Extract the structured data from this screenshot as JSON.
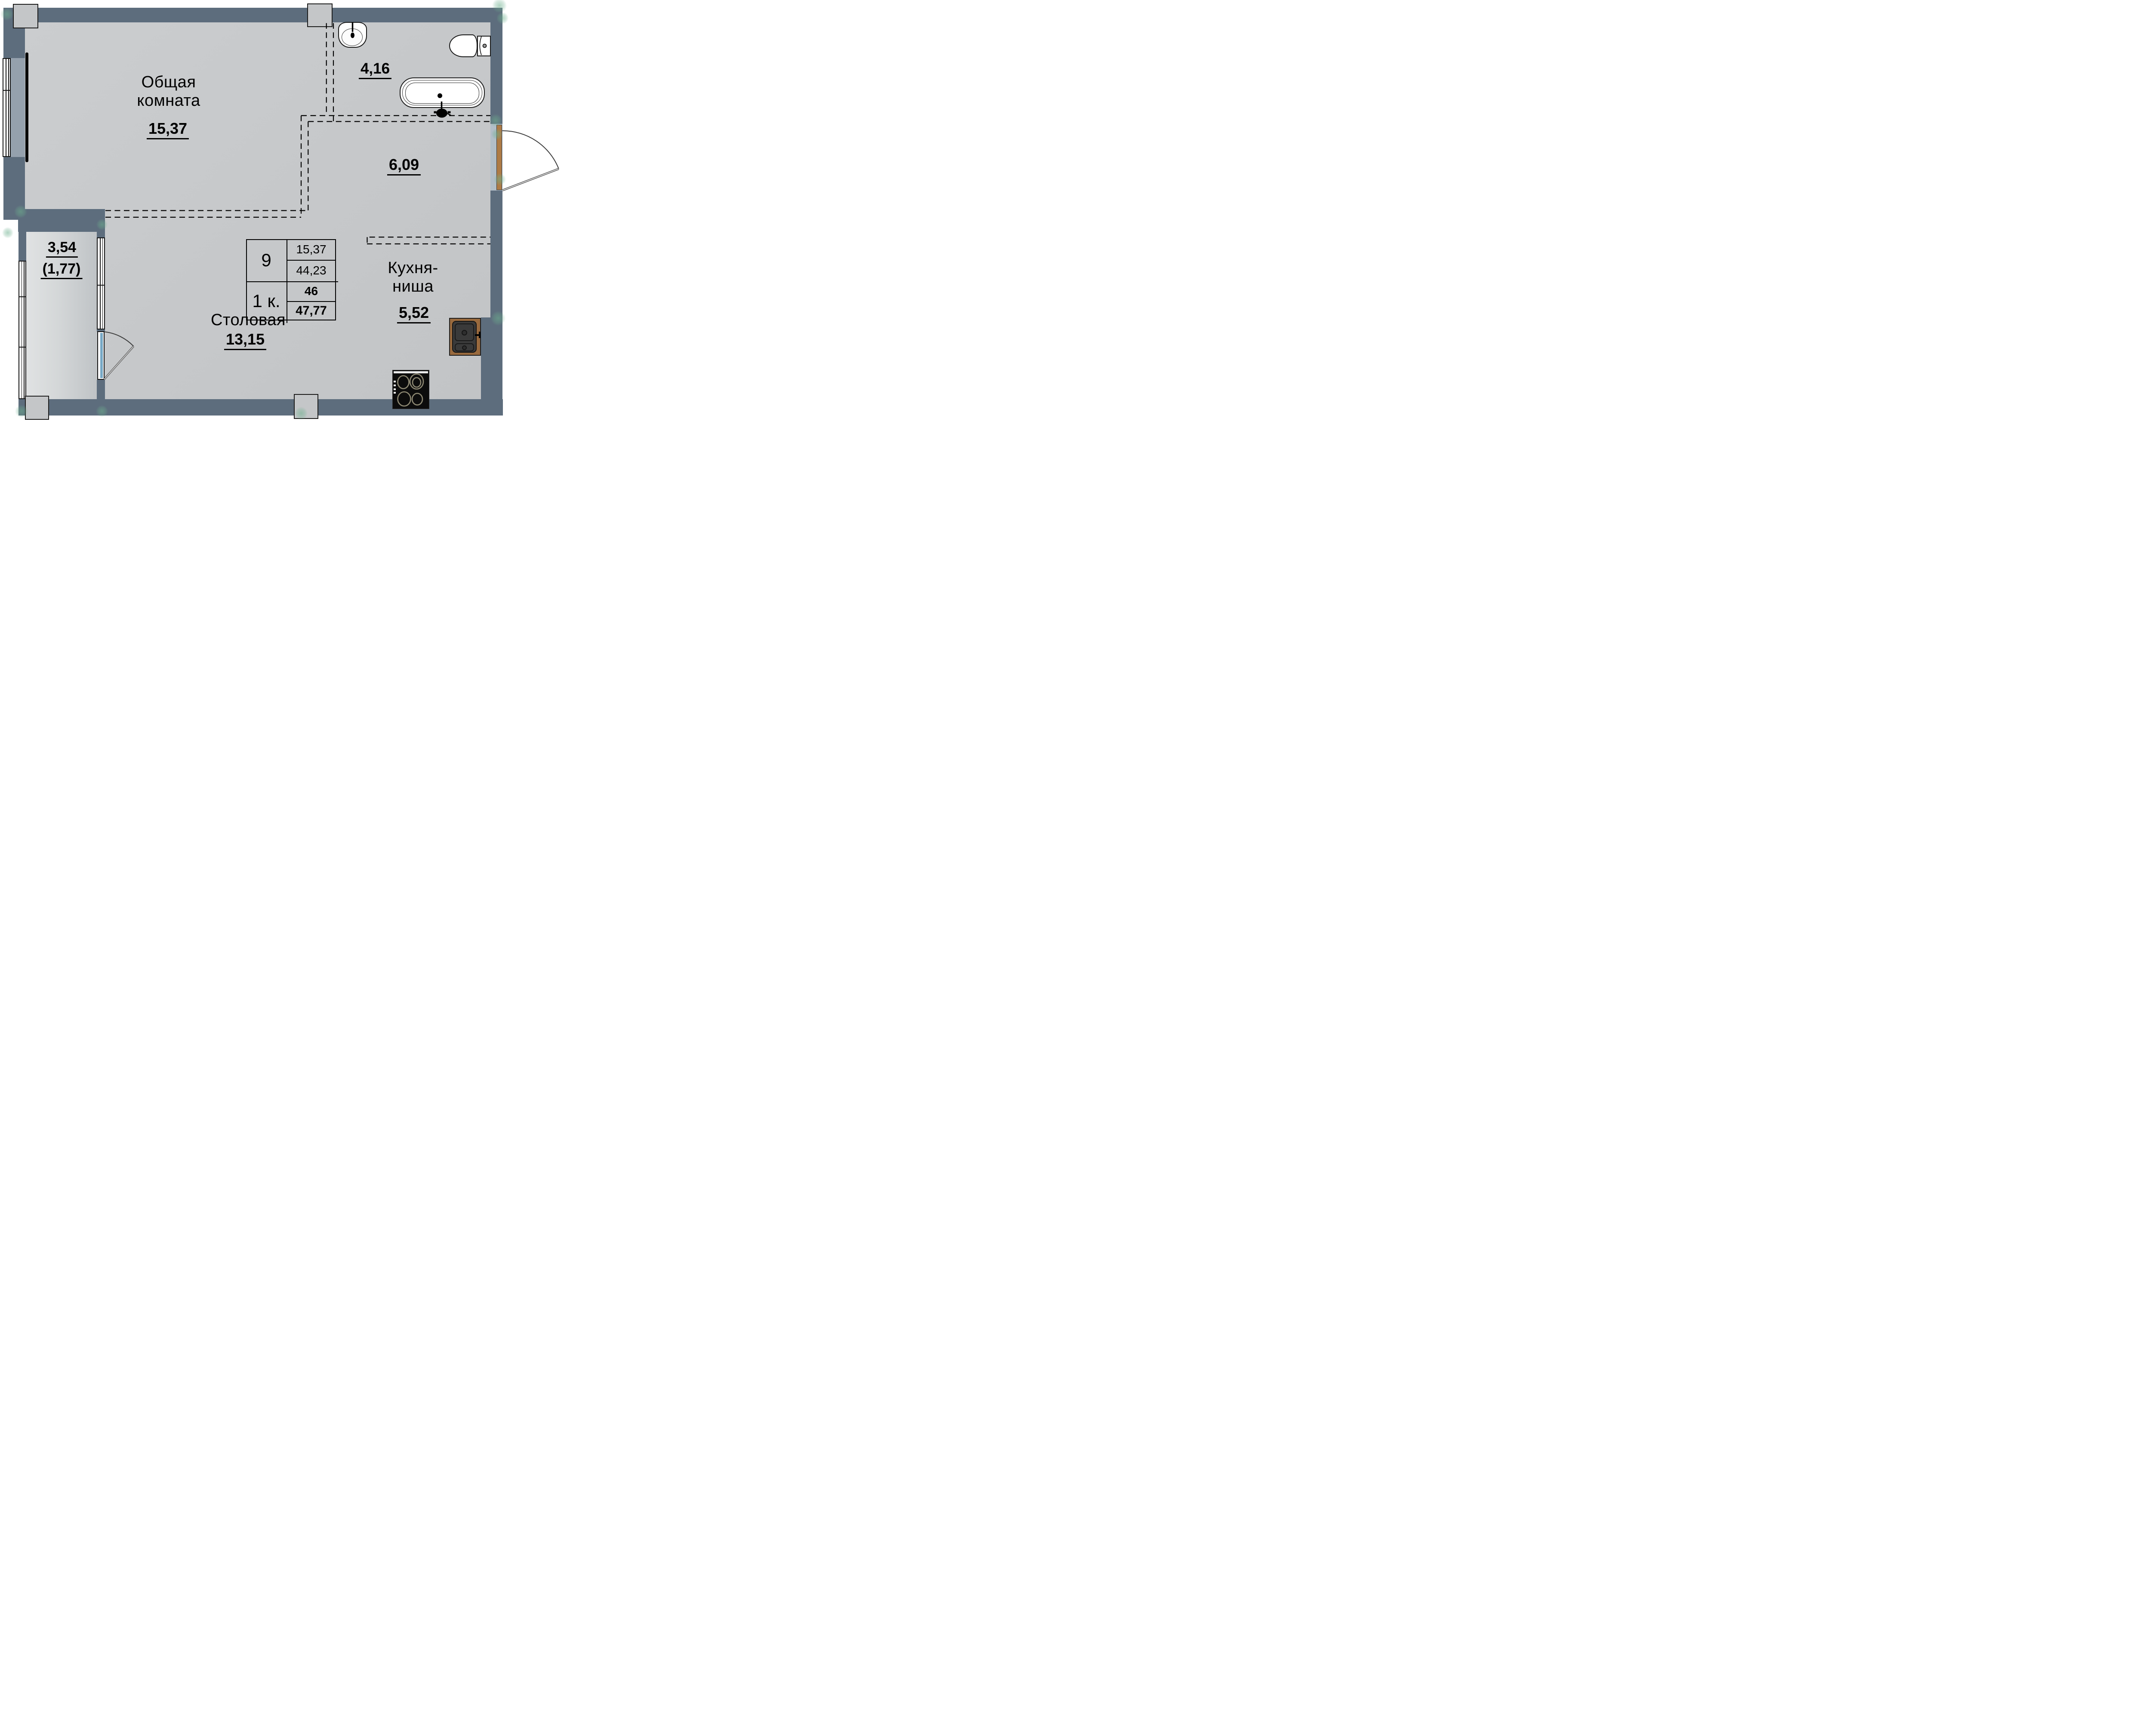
{
  "plan": {
    "kind": "apartment-floor-plan",
    "language": "ru"
  },
  "rooms": {
    "living": {
      "line1": "Общая",
      "line2": "комната",
      "area": "15,37"
    },
    "bathroom": {
      "area": "4,16"
    },
    "hall": {
      "area": "6,09"
    },
    "dining": {
      "name": "Столовая",
      "area": "13,15"
    },
    "kitchen": {
      "line1": "Кухня-",
      "line2": "ниша",
      "area": "5,52"
    },
    "balcony": {
      "area": "3,54",
      "area_coeff": "(1,77)"
    }
  },
  "stamp": {
    "position_on_floor": "9",
    "apartment_type": "1 к.",
    "living_area": "15,37",
    "area_without_balcony": "44,23",
    "apartment_number": "46",
    "total_area": "47,77"
  },
  "colors": {
    "wall": "#5d6d7d",
    "wall_light": "#95a1ad",
    "floor": "#c7c9cb",
    "door_wood": "#ad7b46",
    "door_glass": "#76a7c4",
    "counter_wood": "#996a3e",
    "marker_green": "#6db08e"
  },
  "fixtures": [
    "washbasin",
    "toilet",
    "bathtub",
    "kitchen-sink",
    "stove",
    "radiator"
  ]
}
